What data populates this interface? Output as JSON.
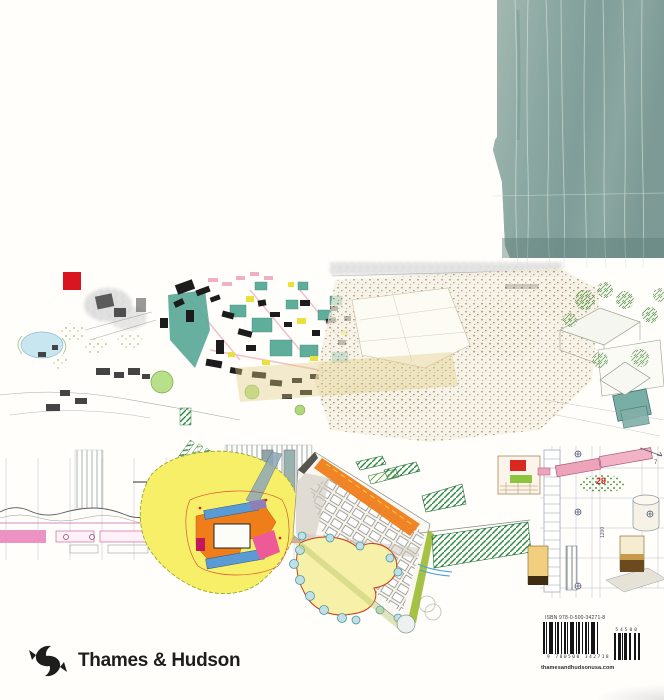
{
  "publisher": {
    "name": "Thames & Hudson",
    "website": "thamesandhudsonusa.com"
  },
  "barcode": {
    "isbn_text": "ISBN 978-0-500-34271-8",
    "ean_digits": "9 780500 342718",
    "addon_digits": "54500"
  },
  "annotations": {
    "plan_detail_number": "29",
    "dimension_label": "1200",
    "arrow_label": "7"
  },
  "colors": {
    "paper": "#fffefb",
    "watercolor_teal": "#86a39d",
    "watercolor_teal_light": "#a9bdb4",
    "watercolor_teal_dark": "#647f7b",
    "red_accent": "#d9161f",
    "masterplan_teal": "#57a795",
    "highlight_yellow": "#e8e23e",
    "plan_yellow": "#f7ef68",
    "plan_orange": "#ef7d1a",
    "plan_blue": "#5b9bd5",
    "plan_pink": "#ee5a98",
    "hatch_green": "#2e8b47",
    "pale_park_yellow": "#f6f0a8",
    "pool_teal": "#78aea6",
    "section_pink": "#ec93c3",
    "slab_pink": "#f3b3c6",
    "ink": "#1d1d1b"
  }
}
